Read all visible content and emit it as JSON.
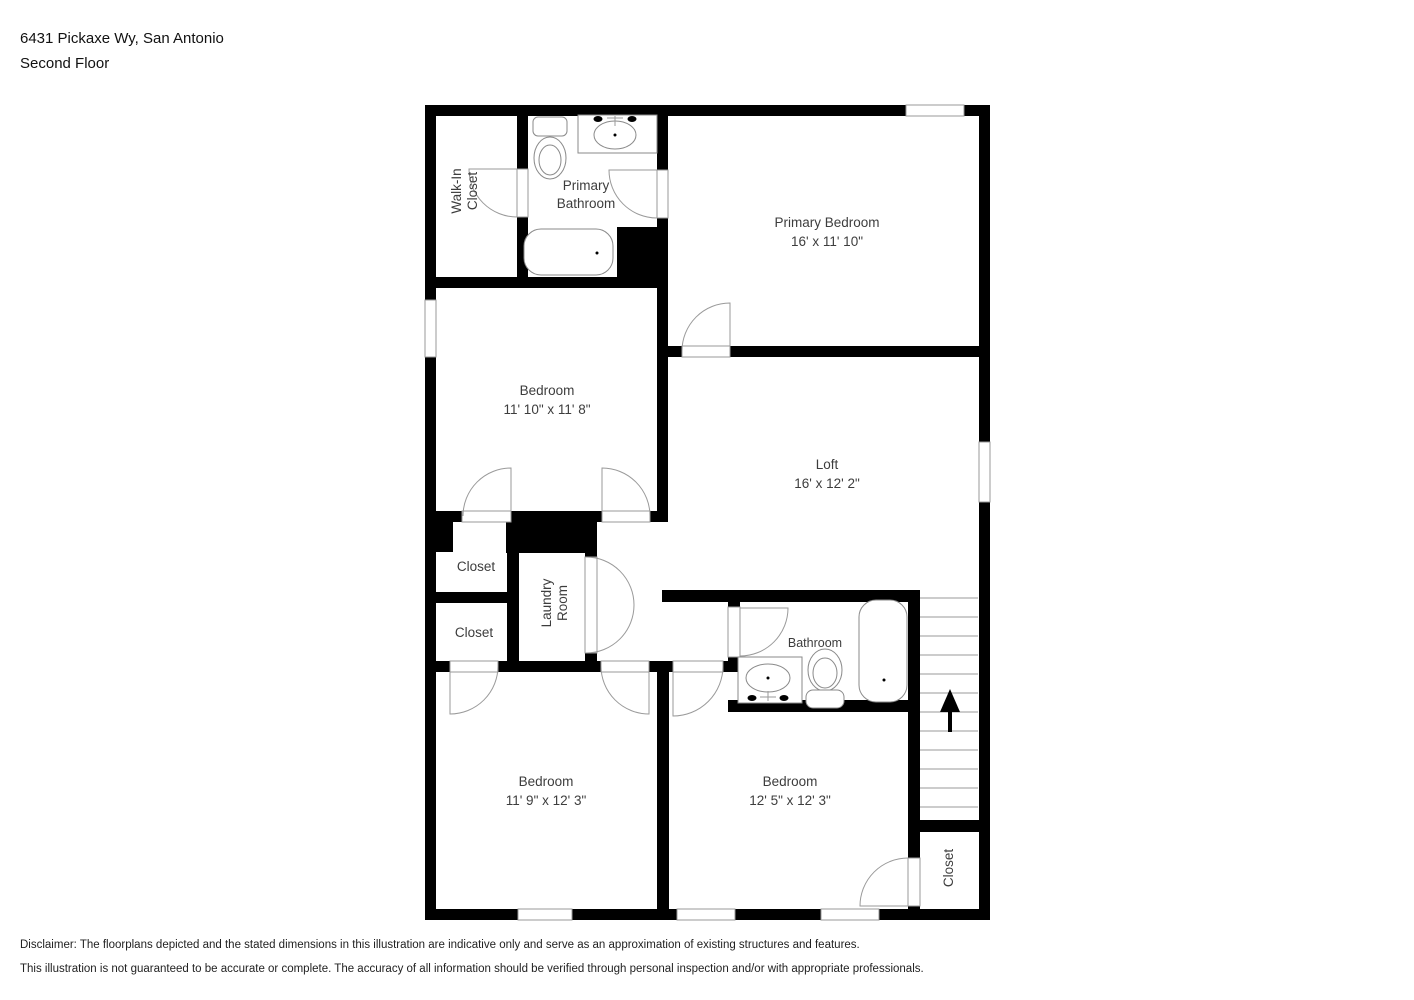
{
  "header": {
    "address": "6431 Pickaxe Wy, San Antonio",
    "floor": "Second Floor"
  },
  "rooms": {
    "walk_in_closet": {
      "line1": "Walk-In",
      "line2": "Closet"
    },
    "primary_bathroom": {
      "line1": "Primary",
      "line2": "Bathroom"
    },
    "primary_bedroom": {
      "name": "Primary Bedroom",
      "dims": "16' x 11' 10\""
    },
    "bedroom_middle": {
      "name": "Bedroom",
      "dims": "11' 10\" x 11' 8\""
    },
    "loft": {
      "name": "Loft",
      "dims": "16' x 12' 2\""
    },
    "closet_upper": {
      "name": "Closet"
    },
    "closet_lower": {
      "name": "Closet"
    },
    "laundry_room": {
      "line1": "Laundry",
      "line2": "Room"
    },
    "bathroom": {
      "name": "Bathroom"
    },
    "bedroom_bottom_left": {
      "name": "Bedroom",
      "dims": "11' 9\" x 12' 3\""
    },
    "bedroom_bottom_right": {
      "name": "Bedroom",
      "dims": "12' 5\" x 12' 3\""
    },
    "closet_bottom_right": {
      "name": "Closet"
    }
  },
  "footer": {
    "disclaimer_line1": "Disclaimer: The floorplans depicted and the stated dimensions in this illustration are indicative only and serve as an approximation of existing structures and features.",
    "disclaimer_line2": "This illustration is not guaranteed to be accurate or complete. The accuracy of all information should be verified through personal inspection and/or with appropriate professionals."
  },
  "colors": {
    "wall": "#000000",
    "door_swing": "#9a9a9a",
    "label_text": "#3d3d3d"
  }
}
